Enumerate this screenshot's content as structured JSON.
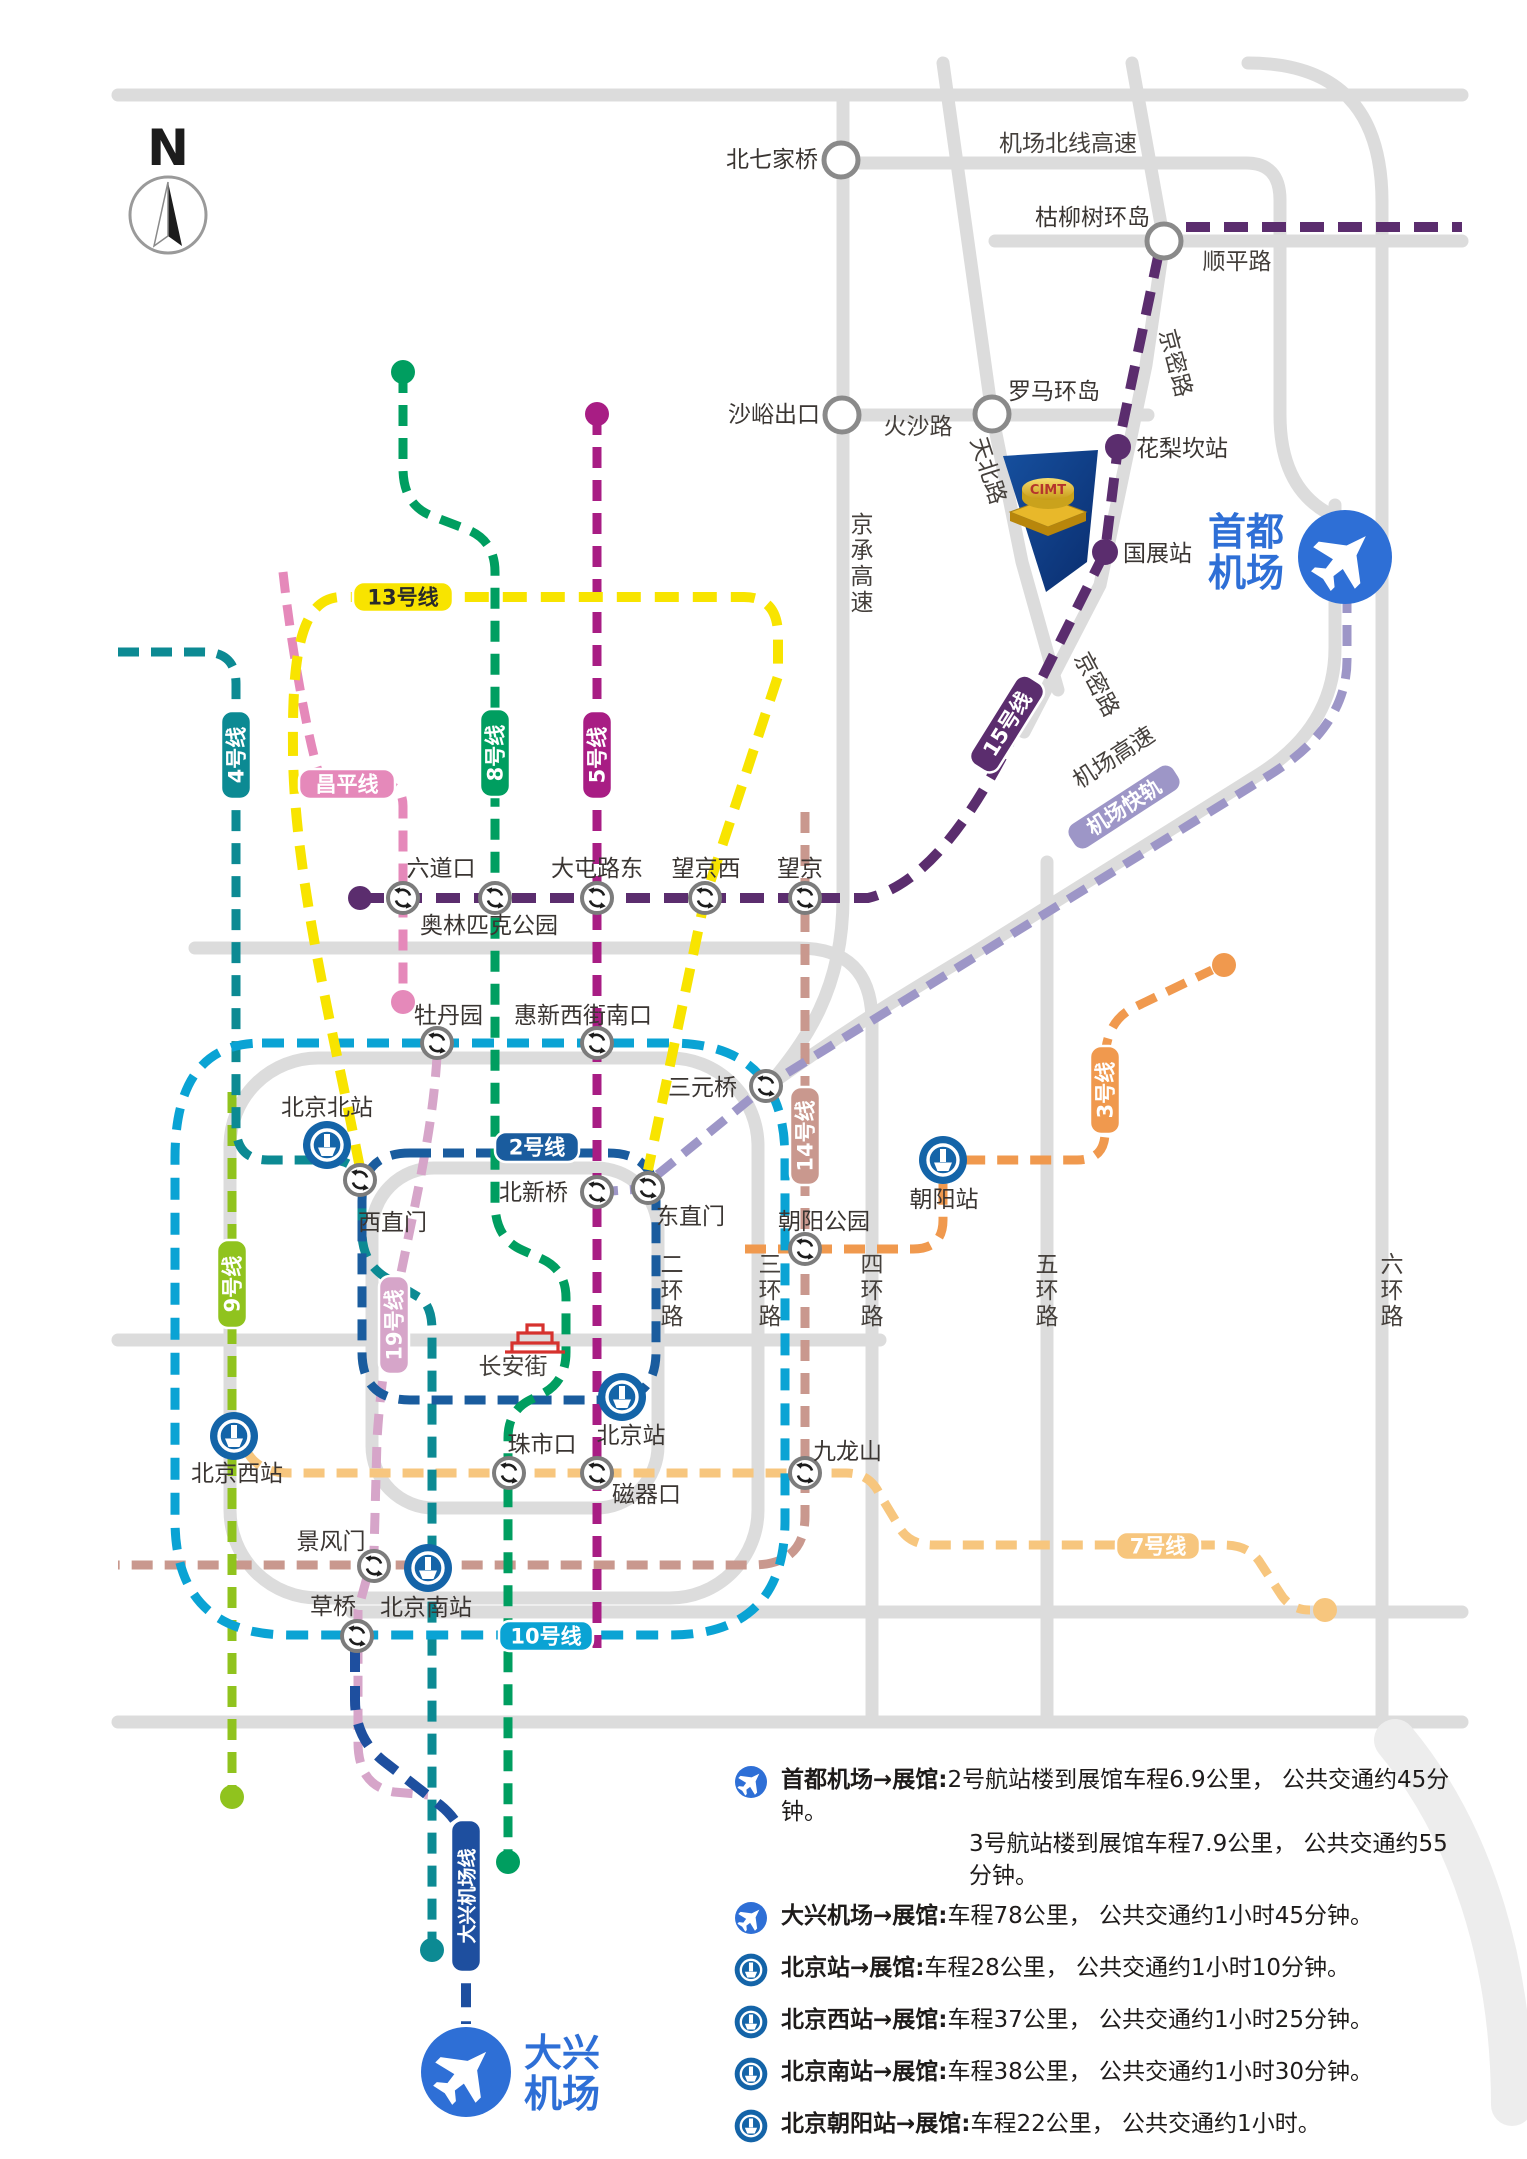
{
  "map": {
    "north_label": "N",
    "venue": {
      "name": "CIMT"
    },
    "airports": {
      "capital": {
        "l1": "首都",
        "l2": "机场"
      },
      "daxing": {
        "l1": "大兴",
        "l2": "机场"
      }
    }
  },
  "colors": {
    "road": "#dcdcdc",
    "airport_blue": "#2e6fd6",
    "rail_blue": "#1464a8",
    "interchange_ring": "#7c7c7c",
    "junction_ring": "#8a8a8a",
    "venue_navy": "#0d3e8e",
    "venue_gold": "#e8b82a",
    "tiananmen_red": "#d6322e"
  },
  "lines": {
    "l15": {
      "label": "15号线",
      "color": "#5b2d6e",
      "tc": "#ffffff"
    },
    "l13": {
      "label": "13号线",
      "color": "#f8e400",
      "tc": "#2a2a2a"
    },
    "l4": {
      "label": "4号线",
      "color": "#0c8a93",
      "tc": "#ffffff"
    },
    "cp": {
      "label": "昌平线",
      "color": "#e589ba",
      "tc": "#ffffff"
    },
    "l8": {
      "label": "8号线",
      "color": "#009e60",
      "tc": "#ffffff"
    },
    "l5": {
      "label": "5号线",
      "color": "#a81d84",
      "tc": "#ffffff"
    },
    "l9": {
      "label": "9号线",
      "color": "#90c31e",
      "tc": "#ffffff"
    },
    "l19": {
      "label": "19号线",
      "color": "#d6a5c9",
      "tc": "#ffffff"
    },
    "l10": {
      "label": "10号线",
      "color": "#0aa3d4",
      "tc": "#ffffff"
    },
    "l2": {
      "label": "2号线",
      "color": "#1a5c9e",
      "tc": "#ffffff"
    },
    "l14": {
      "label": "14号线",
      "color": "#c9988e",
      "tc": "#ffffff"
    },
    "l3": {
      "label": "3号线",
      "color": "#f0994e",
      "tc": "#ffffff"
    },
    "l7": {
      "label": "7号线",
      "color": "#f7c67e",
      "tc": "#ffffff"
    },
    "dx": {
      "label": "大兴机场线",
      "color": "#1e4f9f",
      "tc": "#ffffff"
    },
    "ae": {
      "label": "机场快轨",
      "color": "#9d96c7",
      "tc": "#ffffff"
    }
  },
  "pills": [
    {
      "line": "l13",
      "x": 403,
      "y": 597,
      "w": 100,
      "h": 30,
      "rot": 0
    },
    {
      "line": "l4",
      "x": 236,
      "y": 755,
      "w": 88,
      "h": 30,
      "rot": -90
    },
    {
      "line": "cp",
      "x": 347,
      "y": 784,
      "w": 96,
      "h": 30,
      "rot": 0
    },
    {
      "line": "l8",
      "x": 495,
      "y": 753,
      "w": 88,
      "h": 30,
      "rot": -90
    },
    {
      "line": "l5",
      "x": 597,
      "y": 755,
      "w": 88,
      "h": 30,
      "rot": -90
    },
    {
      "line": "l15",
      "x": 1007,
      "y": 724,
      "w": 104,
      "h": 32,
      "rot": -58
    },
    {
      "line": "ae",
      "x": 1124,
      "y": 807,
      "w": 126,
      "h": 30,
      "rot": -33
    },
    {
      "line": "l9",
      "x": 232,
      "y": 1284,
      "w": 88,
      "h": 30,
      "rot": -90
    },
    {
      "line": "l19",
      "x": 394,
      "y": 1325,
      "w": 98,
      "h": 30,
      "rot": -90
    },
    {
      "line": "l2",
      "x": 537,
      "y": 1147,
      "w": 84,
      "h": 30,
      "rot": 0
    },
    {
      "line": "l14",
      "x": 805,
      "y": 1136,
      "w": 98,
      "h": 30,
      "rot": -90
    },
    {
      "line": "l3",
      "x": 1105,
      "y": 1090,
      "w": 88,
      "h": 30,
      "rot": -90
    },
    {
      "line": "l10",
      "x": 546,
      "y": 1636,
      "w": 94,
      "h": 30,
      "rot": 0
    },
    {
      "line": "l7",
      "x": 1158,
      "y": 1546,
      "w": 84,
      "h": 28,
      "rot": 0
    },
    {
      "line": "dx",
      "x": 466,
      "y": 1896,
      "w": 152,
      "h": 30,
      "rot": -90,
      "fs": 19
    }
  ],
  "stations": {
    "junctions": [
      {
        "name": "北七家桥",
        "x": 841,
        "y": 160,
        "lx": 818,
        "ly": 167,
        "anchor": "end"
      },
      {
        "name": "枯柳树环岛",
        "x": 1164,
        "y": 241,
        "lx": 1150,
        "ly": 225,
        "anchor": "end"
      },
      {
        "name": "罗马环岛",
        "x": 992,
        "y": 414,
        "lx": 1008,
        "ly": 399,
        "anchor": "start"
      },
      {
        "name": "沙峪出口",
        "x": 842,
        "y": 415,
        "lx": 820,
        "ly": 422,
        "anchor": "end"
      }
    ],
    "interchanges": [
      {
        "name": "六道口",
        "x": 403,
        "y": 898,
        "lx": 441,
        "ly": 876,
        "anchor": "middle"
      },
      {
        "name": "奥林匹克公园",
        "x": 495,
        "y": 898,
        "lx": 489,
        "ly": 933,
        "anchor": "middle"
      },
      {
        "name": "大屯路东",
        "x": 597,
        "y": 898,
        "lx": 597,
        "ly": 876,
        "anchor": "middle"
      },
      {
        "name": "望京西",
        "x": 705,
        "y": 898,
        "lx": 706,
        "ly": 876,
        "anchor": "middle"
      },
      {
        "name": "望京",
        "x": 805,
        "y": 898,
        "lx": 800,
        "ly": 876,
        "anchor": "middle"
      },
      {
        "name": "牡丹园",
        "x": 437,
        "y": 1043,
        "lx": 414,
        "ly": 1023,
        "anchor": "start"
      },
      {
        "name": "惠新西街南口",
        "x": 597,
        "y": 1043,
        "lx": 583,
        "ly": 1023,
        "anchor": "middle"
      },
      {
        "name": "三元桥",
        "x": 766,
        "y": 1086,
        "lx": 737,
        "ly": 1095,
        "anchor": "end"
      },
      {
        "name": "西直门",
        "x": 360,
        "y": 1180,
        "lx": 358,
        "ly": 1230,
        "anchor": "start"
      },
      {
        "name": "北新桥",
        "x": 597,
        "y": 1192,
        "lx": 568,
        "ly": 1200,
        "anchor": "end"
      },
      {
        "name": "东直门",
        "x": 648,
        "y": 1188,
        "lx": 656,
        "ly": 1224,
        "anchor": "start"
      },
      {
        "name": "朝阳公园",
        "x": 805,
        "y": 1249,
        "lx": 824,
        "ly": 1229,
        "anchor": "middle"
      },
      {
        "name": "珠市口",
        "x": 509,
        "y": 1473,
        "lx": 542,
        "ly": 1452,
        "anchor": "middle"
      },
      {
        "name": "磁器口",
        "x": 597,
        "y": 1473,
        "lx": 612,
        "ly": 1502,
        "anchor": "start"
      },
      {
        "name": "九龙山",
        "x": 805,
        "y": 1473,
        "lx": 813,
        "ly": 1459,
        "anchor": "start"
      },
      {
        "name": "景风门",
        "x": 374,
        "y": 1566,
        "lx": 331,
        "ly": 1549,
        "anchor": "middle"
      },
      {
        "name": "草桥",
        "x": 357,
        "y": 1636,
        "lx": 333,
        "ly": 1614,
        "anchor": "middle"
      }
    ],
    "rail": [
      {
        "name": "北京北站",
        "x": 327,
        "y": 1145,
        "lx": 327,
        "ly": 1115,
        "anchor": "middle"
      },
      {
        "name": "北京站",
        "x": 622,
        "y": 1397,
        "lx": 631,
        "ly": 1443,
        "anchor": "middle"
      },
      {
        "name": "北京西站",
        "x": 234,
        "y": 1436,
        "lx": 237,
        "ly": 1481,
        "anchor": "middle"
      },
      {
        "name": "北京南站",
        "x": 428,
        "y": 1568,
        "lx": 426,
        "ly": 1615,
        "anchor": "middle"
      },
      {
        "name": "朝阳站",
        "x": 943,
        "y": 1160,
        "lx": 944,
        "ly": 1207,
        "anchor": "middle"
      }
    ],
    "dots": [
      {
        "line": "l15",
        "x": 360,
        "y": 898,
        "r": 12
      },
      {
        "line": "l8",
        "x": 403,
        "y": 372,
        "r": 12
      },
      {
        "line": "l5",
        "x": 597,
        "y": 414,
        "r": 12
      },
      {
        "line": "cp",
        "x": 403,
        "y": 1002,
        "r": 12
      },
      {
        "line": "l15",
        "x": 1118,
        "y": 447,
        "r": 13,
        "name": "花梨坎站",
        "lx": 1136,
        "ly": 456,
        "anchor": "start"
      },
      {
        "line": "l15",
        "x": 1105,
        "y": 552,
        "r": 13,
        "name": "国展站",
        "lx": 1123,
        "ly": 561,
        "anchor": "start"
      },
      {
        "line": "l8",
        "x": 508,
        "y": 1862,
        "r": 12
      },
      {
        "line": "l9",
        "x": 232,
        "y": 1797,
        "r": 12
      },
      {
        "line": "l4",
        "x": 432,
        "y": 1950,
        "r": 12
      },
      {
        "line": "l3",
        "x": 1224,
        "y": 965,
        "r": 12
      },
      {
        "line": "l7",
        "x": 1325,
        "y": 1610,
        "r": 12
      }
    ]
  },
  "roads": {
    "labels": [
      {
        "t": "机场北线高速",
        "x": 1068,
        "y": 151
      },
      {
        "t": "顺平路",
        "x": 1237,
        "y": 269
      },
      {
        "t": "京密路",
        "x": 1168,
        "y": 365,
        "rot": 75
      },
      {
        "t": "火沙路",
        "x": 918,
        "y": 434
      },
      {
        "t": "天北路",
        "x": 981,
        "y": 473,
        "rot": 72
      },
      {
        "t": "京承高速",
        "x": 862,
        "y": 532,
        "vert": true
      },
      {
        "t": "京密路",
        "x": 1090,
        "y": 688,
        "rot": 62
      },
      {
        "t": "机场高速",
        "x": 1118,
        "y": 764,
        "rot": -33
      },
      {
        "t": "二环路",
        "x": 672,
        "y": 1272,
        "vert": true
      },
      {
        "t": "三环路",
        "x": 770,
        "y": 1272,
        "vert": true
      },
      {
        "t": "四环路",
        "x": 872,
        "y": 1272,
        "vert": true
      },
      {
        "t": "五环路",
        "x": 1047,
        "y": 1272,
        "vert": true
      },
      {
        "t": "六环路",
        "x": 1392,
        "y": 1272,
        "vert": true
      },
      {
        "t": "长安街",
        "x": 513,
        "y": 1374
      }
    ]
  },
  "legend": {
    "rows": [
      {
        "icon": "plane",
        "title": "首都机场→展馆:",
        "text": "2号航站楼到展馆车程6.9公里， 公共交通约45分钟。",
        "text2": "3号航站楼到展馆车程7.9公里， 公共交通约55分钟。"
      },
      {
        "icon": "plane",
        "title": "大兴机场→展馆:",
        "text": "车程78公里， 公共交通约1小时45分钟。"
      },
      {
        "icon": "rail",
        "title": "北京站→展馆:",
        "text": "车程28公里， 公共交通约1小时10分钟。"
      },
      {
        "icon": "rail",
        "title": "北京西站→展馆:",
        "text": "车程37公里， 公共交通约1小时25分钟。"
      },
      {
        "icon": "rail",
        "title": "北京南站→展馆:",
        "text": "车程38公里， 公共交通约1小时30分钟。"
      },
      {
        "icon": "rail",
        "title": "北京朝阳站→展馆:",
        "text": "车程22公里， 公共交通约1小时。"
      }
    ],
    "note": "（以上路程时间仅供参考，具体时间以实际路况为准）"
  }
}
